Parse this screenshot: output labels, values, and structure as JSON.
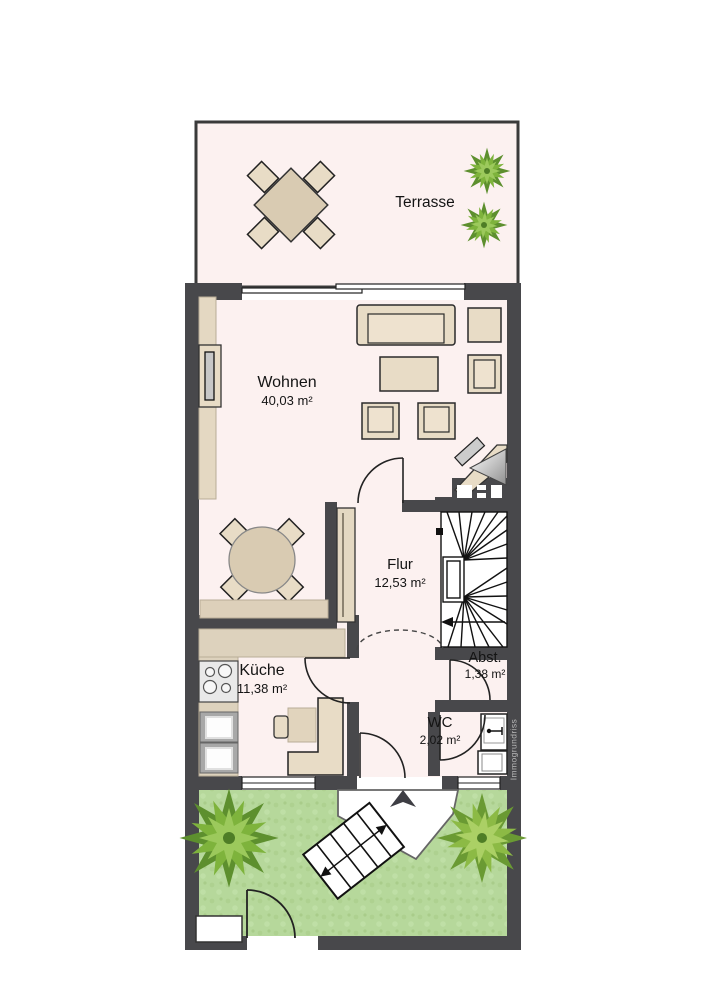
{
  "plan": {
    "watermark": "Immogrundriss",
    "rooms": [
      {
        "name": "Terrasse",
        "area": ""
      },
      {
        "name": "Wohnen",
        "area": "40,03 m²"
      },
      {
        "name": "Flur",
        "area": "12,53 m²"
      },
      {
        "name": "Küche",
        "area": "11,38 m²"
      },
      {
        "name": "Abst.",
        "area": "1,38 m²"
      },
      {
        "name": "WC",
        "area": "2,02 m²"
      }
    ],
    "colors": {
      "wall": "#48484b",
      "floor": "#fcf1f0",
      "garden": "#b6d89b",
      "furniture": "#e8dcc6",
      "furniture_dark": "#d9cbb2",
      "tree_dark": "#5d8f2e",
      "tree_mid": "#7eb33c",
      "tree_light": "#9cc95c",
      "text": "#141414",
      "watermark_text": "#b9b9b9"
    }
  }
}
